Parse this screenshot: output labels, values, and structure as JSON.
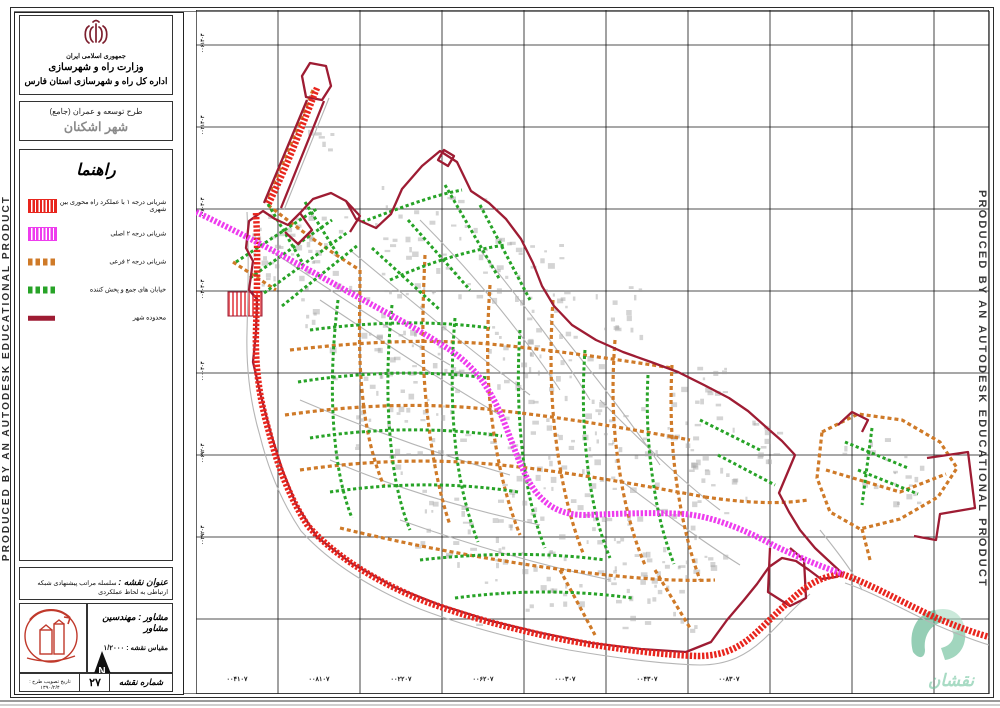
{
  "stamp_text": "PRODUCED BY AN AUTODESK EDUCATIONAL PRODUCT",
  "title_block": {
    "country": "جمهوری اسلامی ایران",
    "ministry": "وزارت راه و شهرسازی",
    "department": "اداره کل راه و شهرسازی استان فارس",
    "plan_type": "طرح توسعه و عمران (جامع)",
    "city": "شهر اشکنان",
    "legend": {
      "title": "راهنما",
      "items": [
        {
          "label": "شریانی درجه ۱ با عملکرد راه محوری بین شهری",
          "color": "#e8251d",
          "style": "hatched"
        },
        {
          "label": "شریانی درجه ۲ اصلی",
          "color": "#ee3cee",
          "style": "hatched"
        },
        {
          "label": "شریانی درجه ۲ فرعی",
          "color": "#cf7a28",
          "style": "dashed"
        },
        {
          "label": "خیابان های جمع و پخش کننده",
          "color": "#27a327",
          "style": "dashed"
        },
        {
          "label": "محدوده شهر",
          "color": "#9e1c33",
          "style": "solid"
        }
      ]
    },
    "map_title_label": "عنوان نقشه :",
    "map_title_text": "سلسله مراتب پیشنهادی شبکه ارتباطی به لحاظ عملکردی",
    "consultant": "مشاور : مهندسین مشاور",
    "scale_label": "مقیاس نقشه : ۱/۲۰۰۰",
    "approval_date": "تاریخ تصویب طرح : ۱۳۹۰/۲/۴",
    "sheet_no": "۲۷",
    "sheet_no_label": "شماره نقشه"
  },
  "map": {
    "logo_word": "نقشان",
    "grid": {
      "x_lines": [
        278,
        360,
        442,
        524,
        606,
        688,
        770,
        852,
        934
      ],
      "y_lines": [
        45,
        127,
        209,
        291,
        373,
        455,
        537,
        619
      ],
      "frame": {
        "x1": 196,
        "y1": 10,
        "x2": 989,
        "y2": 694
      }
    },
    "bottom_labels": [
      {
        "x": 237,
        "text": "۰۰۴۱۰۷"
      },
      {
        "x": 319,
        "text": "۰۰۸۱۰۷"
      },
      {
        "x": 401,
        "text": "۰۰۲۲۰۷"
      },
      {
        "x": 483,
        "text": "۰۰۶۲۰۷"
      },
      {
        "x": 565,
        "text": "۰۰۰۳۰۷"
      },
      {
        "x": 647,
        "text": "۰۰۴۳۰۷"
      },
      {
        "x": 729,
        "text": "۰۰۸۳۰۷"
      }
    ],
    "left_labels": [
      {
        "y": 45,
        "text": "۰۰۶۱۳۰۳"
      },
      {
        "y": 127,
        "text": "۰۰۲۱۳۰۳"
      },
      {
        "y": 209,
        "text": "۰۰۸۰۳۰۳"
      },
      {
        "y": 291,
        "text": "۰۰۴۰۳۰۳"
      },
      {
        "y": 373,
        "text": "۰۰۰۰۳۰۳"
      },
      {
        "y": 455,
        "text": "۰۰۶۹۲۰۳"
      },
      {
        "y": 537,
        "text": "۰۰۲۹۲۰۳"
      }
    ],
    "roads": {
      "gray": [
        "M247,212 C249,250 248,292 247,332 C246,368 250,402 260,436 C268,468 281,501 301,531 C332,565 373,589 420,609 C467,627 518,640 569,650 C616,658 662,664 700,665 C728,665 747,655 764,639 C780,624 794,607 810,594",
        "M845,583 C872,592 900,608 934,624 C957,634 976,641 989,645",
        "M310,95 L266,200",
        "M329,98 L284,210",
        "M270,250 C330,290 390,330 450,365",
        "M320,300 C380,340 440,380 500,415",
        "M350,250 C410,300 470,350 530,395",
        "M420,220 C470,270 520,330 560,390",
        "M300,400 C370,430 440,455 510,475",
        "M330,460 C400,490 470,510 540,525",
        "M480,250 C520,300 560,350 590,400",
        "M550,320 C590,370 630,420 660,465",
        "M600,400 C640,440 680,480 720,510",
        "M400,520 C470,545 540,565 610,580",
        "M620,480 C660,510 700,540 740,565",
        "M820,530 C840,555 855,575 862,590"
      ],
      "boundary": [
        "M306,97 L302,76 L310,63 L326,66 L331,86 L322,100 Z",
        "M307,100 L264,203",
        "M324,101 L281,208",
        "M263,211 L249,221 L246,248 L253,261 L249,290 L257,299 L256,332 L253,362 L261,396 L271,434 L282,469 L296,504 L317,537 L351,563 L394,587 L440,605 L491,621 L541,633 L591,643 L641,649 L686,652 L711,642 L727,620 L744,600 L757,584 L769,567 L782,558 L796,561 L809,570 L821,579 L836,577 L843,574 L830,562 L815,548 L800,530 L789,512 L779,493 L787,474 L795,455 L782,441 L766,427 L748,411 L729,398 L704,385 L678,372 L651,362 L623,352 L596,340 L572,325 L554,306 L542,286 L533,263 L521,239 L506,219 L489,203 L471,191 L457,162 L440,151 L422,166 L402,189 L391,214 L376,228 L356,219 L346,201 L331,193 L313,199 L300,213 L288,225 L275,219 Z",
        "M300,213 L312,230 L298,244 L285,232",
        "M346,201 L360,216 L350,232",
        "M927,458 L968,452 L975,508 L940,514 L936,540 L914,536",
        "M770,548 L768,592 L790,606 L806,598 L804,560 L790,548",
        "M838,425 L852,412 L868,420 L862,432",
        "M444,150 l10,6 l-6,10 l-10,-6 Z"
      ],
      "orange": [
        "M313,90 C300,122 285,160 265,202",
        "M268,205 C300,230 330,252 360,270",
        "M360,270 C360,310 358,350 362,390 C365,425 372,458 384,486",
        "M425,255 C423,300 421,350 426,400 C430,445 438,490 450,525",
        "M490,285 C487,330 486,375 492,420 C497,460 506,500 520,535",
        "M553,300 C550,345 550,395 556,440 C561,480 570,520 583,553",
        "M615,340 C612,380 612,420 618,460 C623,498 632,535 645,565",
        "M672,365 C670,405 671,445 677,485 C682,520 690,553 700,580",
        "M290,350 C360,342 430,338 500,345 C560,351 620,360 672,368",
        "M285,415 C355,405 425,402 495,410 C560,417 625,428 690,440",
        "M300,470 C370,460 440,458 510,466 C575,473 640,485 705,497",
        "M340,528 C410,545 480,558 550,568 C610,576 665,582 715,580",
        "M705,497 C740,502 775,505 808,500",
        "M822,432 L858,414 L902,420 L940,442 L957,468 L938,497 L900,519 L860,529 L830,512 L817,478 Z",
        "M826,470 L900,492 L946,474",
        "M862,529 L870,560",
        "M233,262 L276,290",
        "M560,570 L595,635",
        "M655,570 L690,628"
      ],
      "green": [
        "M236,262 L318,208",
        "M250,278 L332,220",
        "M264,293 L348,232",
        "M282,306 L358,245",
        "M268,204 L302,262",
        "M305,202 L338,255",
        "M362,222 C395,210 430,196 462,190",
        "M372,248 L440,310",
        "M408,220 L470,290",
        "M445,185 L500,280",
        "M390,280 C430,262 470,250 505,245",
        "M480,205 L530,300",
        "M310,330 C370,322 430,320 490,328",
        "M298,382 C360,372 425,370 488,378",
        "M310,438 C372,428 438,427 502,436",
        "M330,492 C392,483 455,482 518,492",
        "M338,300 C332,350 330,400 336,450 C339,475 344,498 352,518",
        "M392,305 C387,355 386,405 392,455 C395,482 401,508 410,530",
        "M455,318 C451,365 451,412 457,458 C461,488 468,516 478,542",
        "M520,330 C517,375 518,420 524,464 C528,494 535,523 545,548",
        "M585,350 C582,392 583,434 589,476 C593,506 600,534 610,558",
        "M648,375 C646,412 648,450 654,487 C658,515 665,541 674,564",
        "M420,560 C480,553 545,552 605,560",
        "M455,598 C515,590 575,590 632,598",
        "M700,420 L760,450",
        "M718,455 L775,485",
        "M845,442 L908,468",
        "M858,470 L918,494",
        "M872,428 L862,505"
      ],
      "red": [
        "M317,88 C305,118 290,160 268,205",
        "M256,213 C258,248 257,290 256,330 C255,365 259,398 269,432 C277,464 289,497 308,526 C338,559 378,582 424,601 C470,618 520,631 571,641 C617,649 662,655 698,656 C724,656 741,647 757,632 C772,618 787,602 804,589 C818,578 833,575 842,574",
        "M842,574 C868,583 898,600 932,616 C955,626 975,633 989,637"
      ],
      "magenta": [
        "M196,212 C245,235 295,262 345,290 C385,312 420,330 450,350 C472,365 485,382 496,404 C508,428 515,455 528,480 C542,505 560,515 585,515 C615,514 650,512 685,514 C715,517 745,530 775,546 C800,558 825,568 843,574"
      ]
    },
    "hatch_area": {
      "x": 228,
      "y": 292,
      "w": 34,
      "h": 24
    },
    "noise_clusters": [
      [
        300,
        248,
        45,
        26
      ],
      [
        430,
        230,
        55,
        32
      ],
      [
        360,
        330,
        60,
        36
      ],
      [
        480,
        330,
        60,
        36
      ],
      [
        420,
        420,
        65,
        40
      ],
      [
        545,
        400,
        60,
        36
      ],
      [
        560,
        480,
        60,
        36
      ],
      [
        640,
        445,
        55,
        30
      ],
      [
        470,
        525,
        55,
        30
      ],
      [
        600,
        560,
        55,
        26
      ],
      [
        680,
        540,
        45,
        22
      ],
      [
        720,
        470,
        40,
        18
      ],
      [
        878,
        470,
        42,
        22
      ],
      [
        525,
        590,
        50,
        22
      ],
      [
        650,
        600,
        45,
        18
      ],
      [
        283,
        253,
        32,
        16
      ],
      [
        320,
        142,
        16,
        6
      ],
      [
        700,
        390,
        35,
        16
      ],
      [
        757,
        441,
        28,
        12
      ],
      [
        595,
        320,
        45,
        24
      ],
      [
        520,
        260,
        40,
        20
      ]
    ]
  }
}
